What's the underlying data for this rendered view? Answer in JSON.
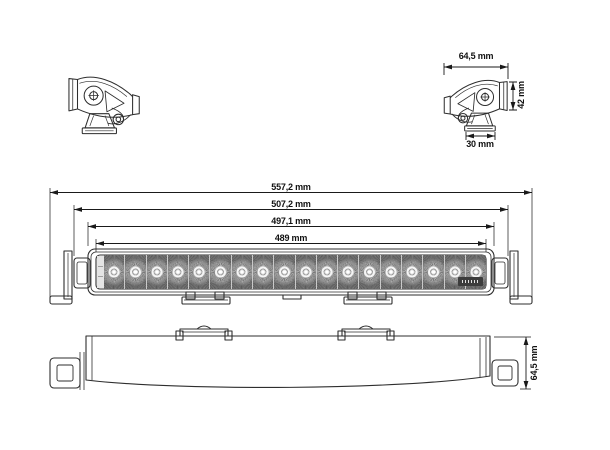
{
  "drawing": {
    "type": "technical-dimension-drawing",
    "subject": "LED light bar with end mounting brackets, four orthographic views",
    "front_view": {
      "led_count": 18,
      "labels": {
        "overall_width": "557,2 mm",
        "mount_knob_width": "507,2 mm",
        "housing_width": "497,1 mm",
        "lens_width": "489 mm"
      }
    },
    "side_view": {
      "labels": {
        "depth": "64,5 mm",
        "height": "42 mm",
        "base_width": "30 mm"
      }
    },
    "top_view": {
      "labels": {
        "depth": "64,5 mm"
      }
    },
    "colors": {
      "background": "#ffffff",
      "line": "#2e2e2e",
      "dimension_line": "#1a1a1a",
      "text": "#111111",
      "lens_fill": "#949494",
      "badge": "#3c3c3c"
    }
  }
}
